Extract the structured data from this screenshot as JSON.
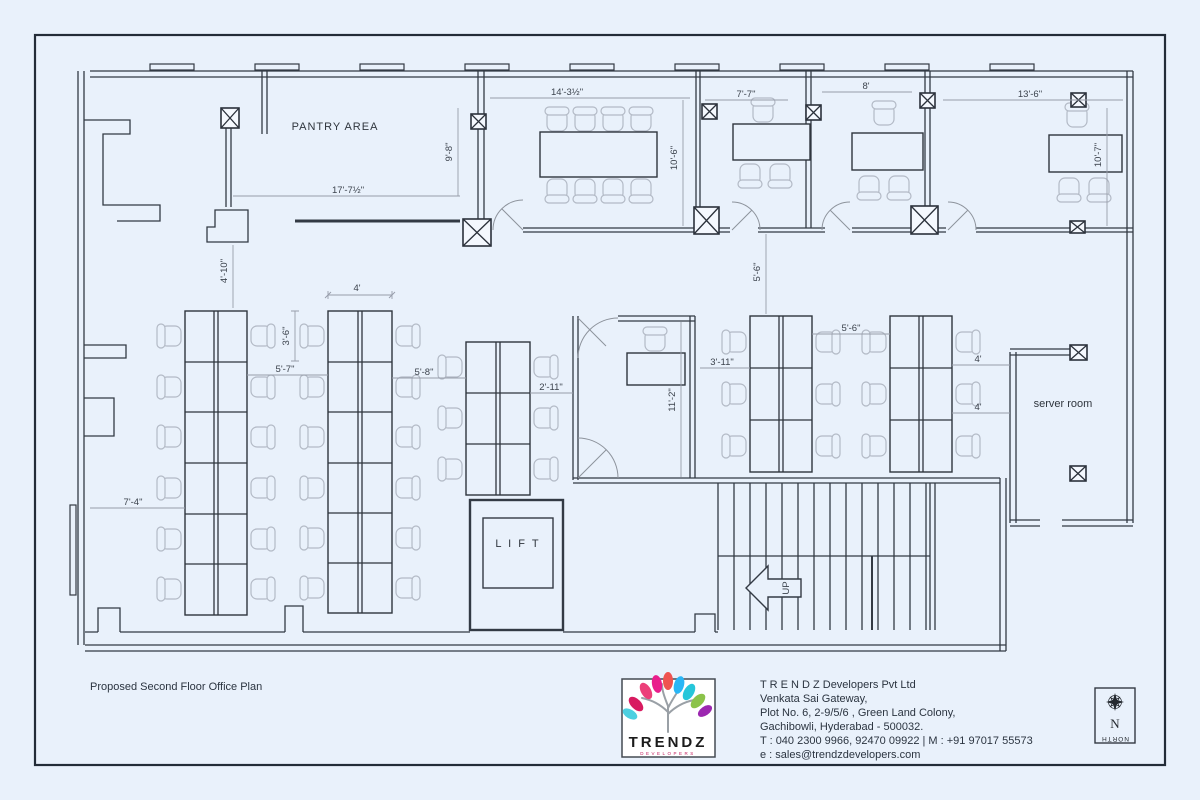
{
  "sheet": {
    "title": "Proposed Second Floor Office Plan"
  },
  "plan": {
    "labels": {
      "pantry": "PANTRY AREA",
      "server": "server room",
      "lift": "L I F T",
      "up": "UP"
    },
    "dims": {
      "pantry_w": "17'-7½\"",
      "pantry_h": "9'-8\"",
      "pantry_v": "4'-10\"",
      "conf_w": "14'-3½\"",
      "conf_h": "10'-6\"",
      "cabin1_w": "7'-7\"",
      "cabin2_w": "8'",
      "room3_w": "13'-6\"",
      "room3_h": "10'-7\"",
      "gap_top": "5'-6\"",
      "clusterB_w": "4'",
      "seg_h": "3'-6\"",
      "gap_ab": "5'-7\"",
      "gap_bc": "5'-8\"",
      "gap_c_corridor": "2'-11\"",
      "left_clear": "7'-4\"",
      "midcabin_h": "11'-2\"",
      "gap_cabin_d": "3'-11\"",
      "gap_de": "5'-6\"",
      "server_gap1": "4'",
      "server_gap2": "4'"
    }
  },
  "footer": {
    "company": {
      "lines": [
        "T R E N D Z   Developers  Pvt Ltd",
        "Venkata Sai Gateway,",
        "Plot No. 6, 2-9/5/6 , Green Land Colony,",
        "Gachibowli, Hyderabad - 500032.",
        "T : 040 2300 9966, 92470 09922 | M : +91 97017 55573",
        "e : sales@trendzdevelopers.com"
      ]
    },
    "logo": {
      "name": "TRENDZ",
      "tagline": "DEVELOPERS"
    },
    "north": {
      "letter": "N",
      "label": "NORTH"
    }
  },
  "colors": {
    "background": "#e9f1fb",
    "wall": "#333a44",
    "dim_line": "#979daa",
    "dim_text": "#3c434d",
    "chair": "#b3bac6",
    "border": "#232c38",
    "logo_leaves": [
      "#d81b60",
      "#ec407a",
      "#e91e8c",
      "#ef5350",
      "#29b6f6",
      "#26c6da",
      "#8bc34a",
      "#9c27b0",
      "#4dd0e1"
    ]
  }
}
